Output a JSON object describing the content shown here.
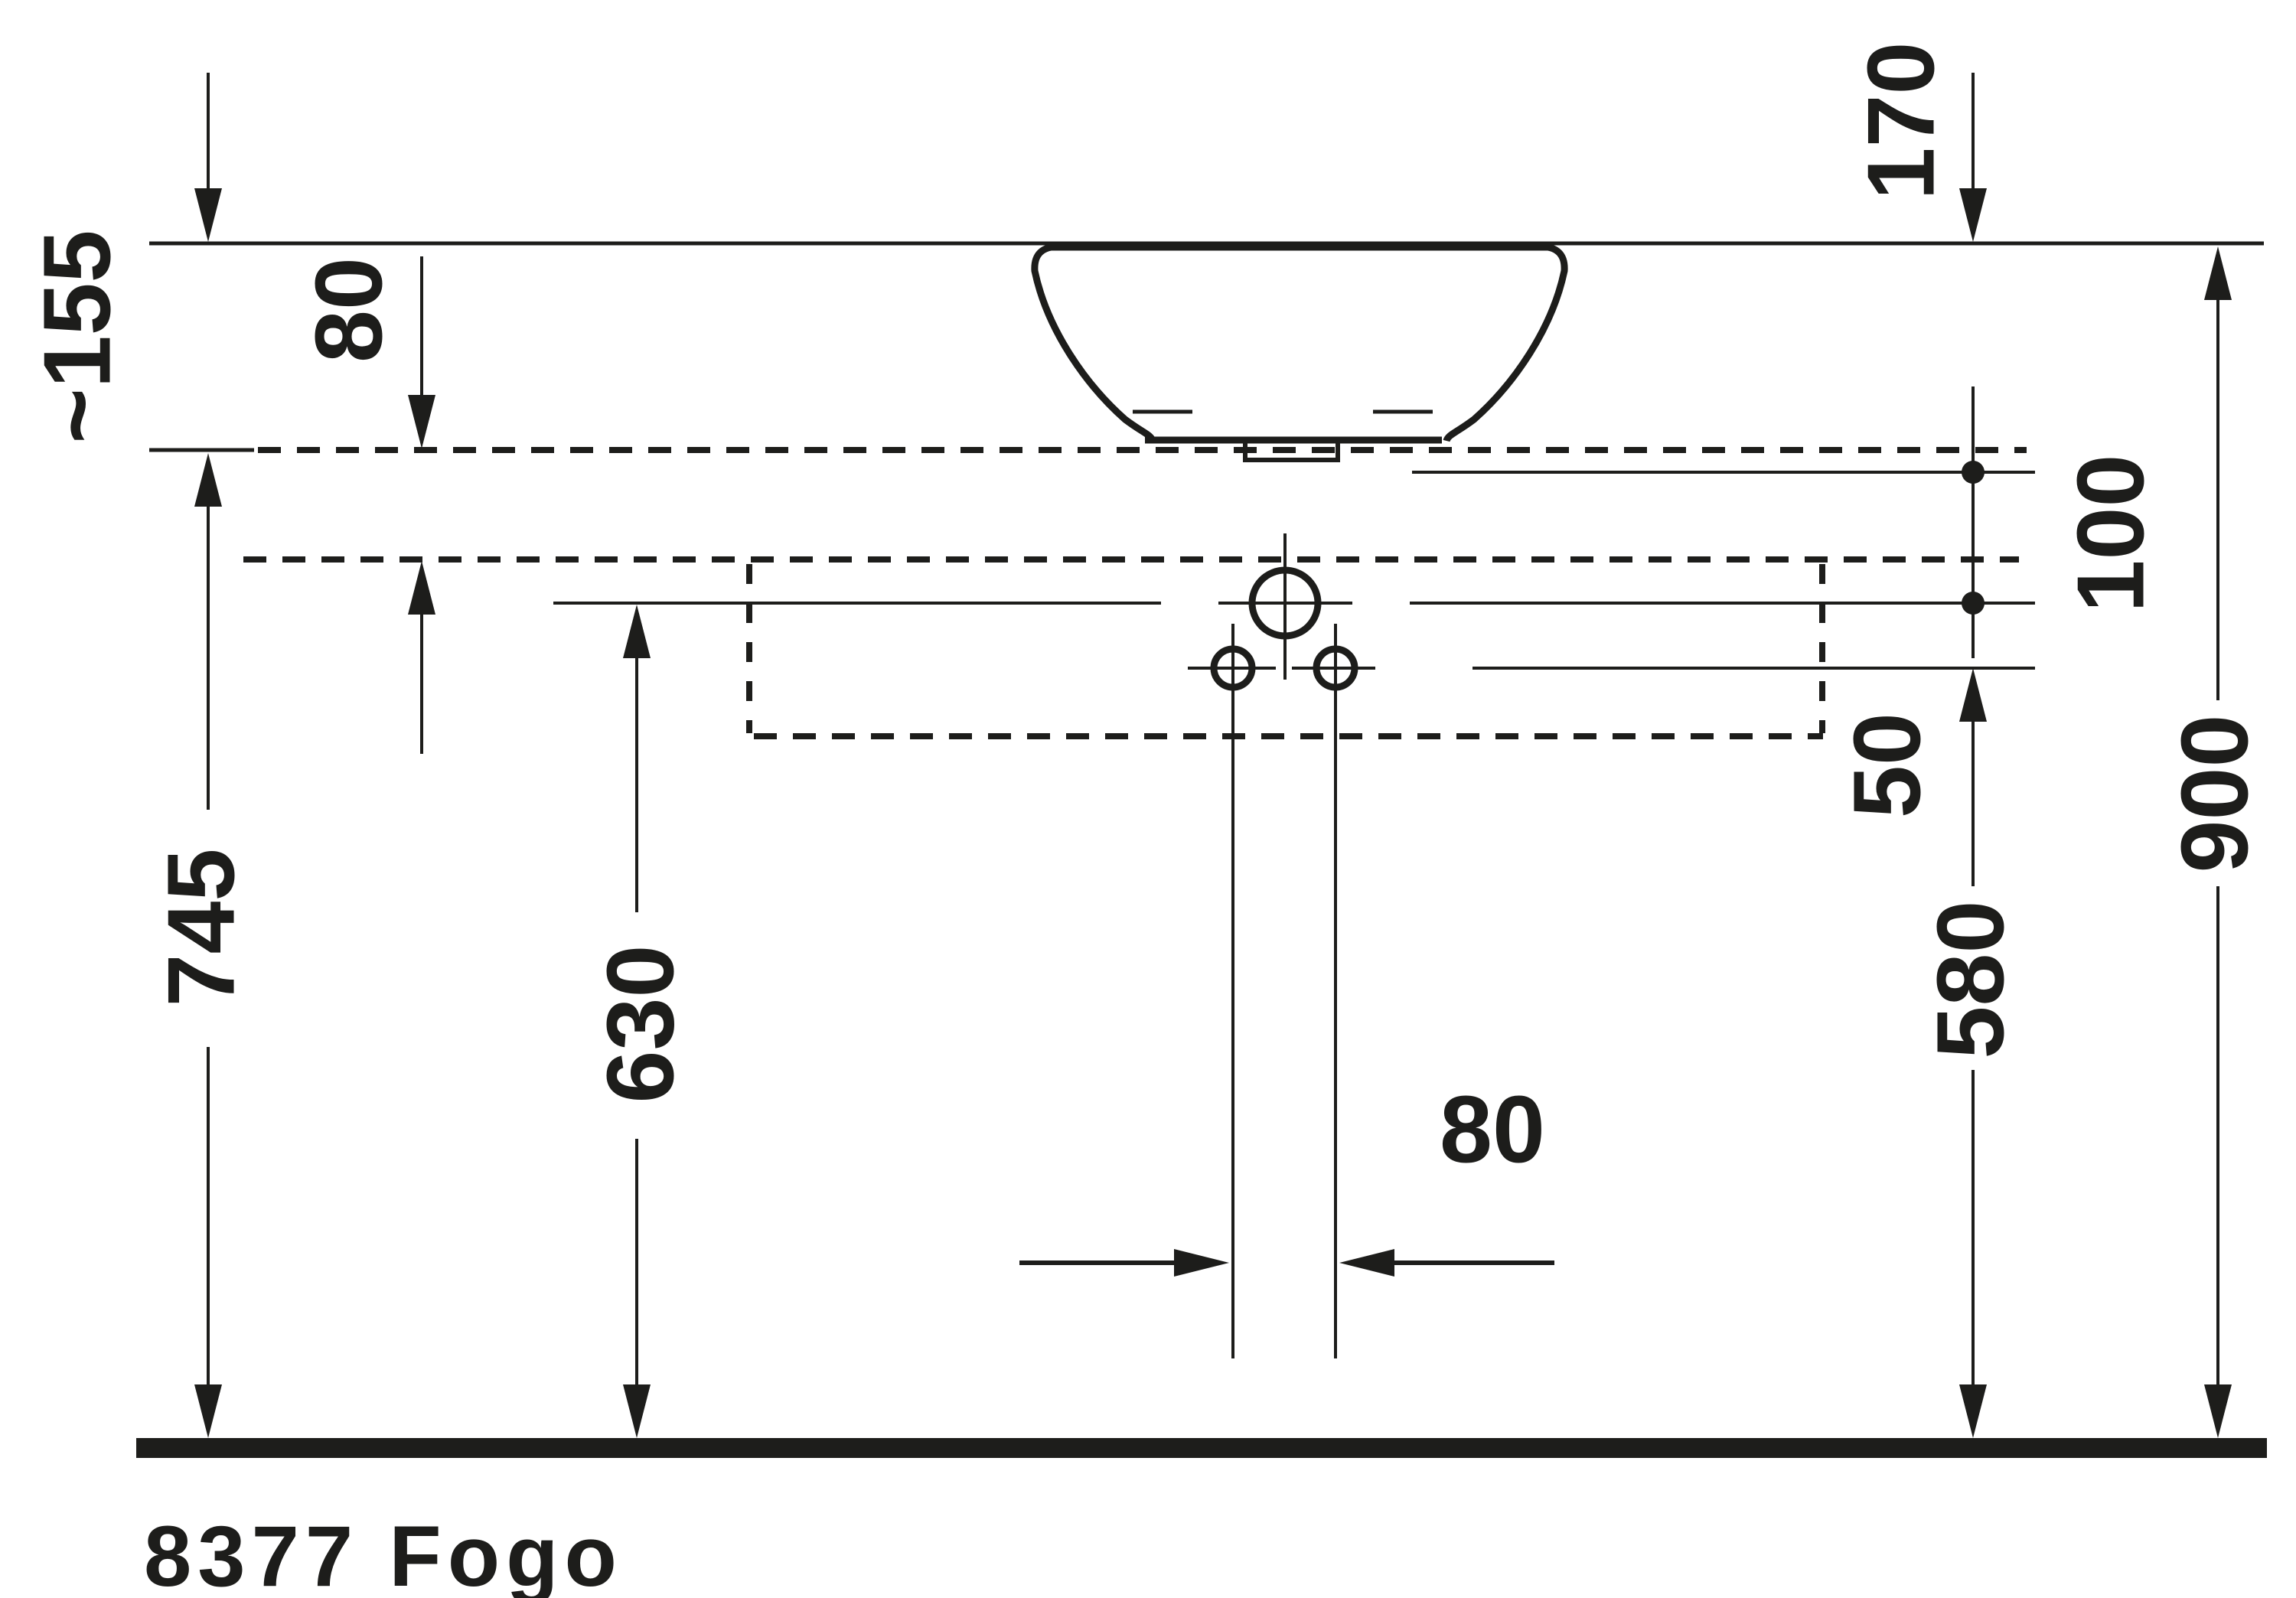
{
  "title": "Technical dimension drawing",
  "product": {
    "label": "8377 Fogo"
  },
  "labels": {
    "basin_above_counter": "~155",
    "counter_panel_thickness": "80",
    "basin_height": "170",
    "supply_line_spacing": "100",
    "hole_offset": "50",
    "counter_top_height": "745",
    "faucet_center_height": "630",
    "small_holes_height": "580",
    "rim_height": "900",
    "hole_spacing": "80"
  }
}
